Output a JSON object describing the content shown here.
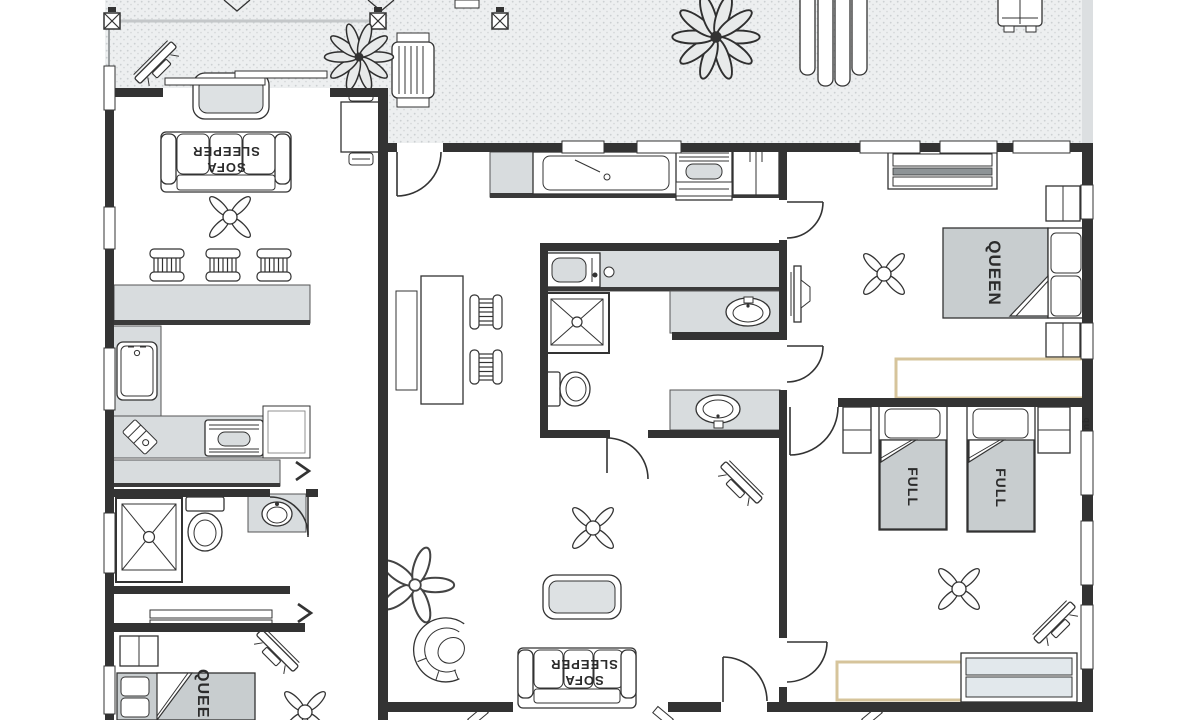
{
  "document": {
    "type": "floor-plan",
    "background": "#ffffff"
  },
  "colors": {
    "wall": "#333333",
    "counter_fill": "#d8dcde",
    "bed_fill": "#c8cdcf",
    "table_fill": "#dde1e3",
    "deck_fill": "#edeff0",
    "deck_dot": "#ccd0d2",
    "closet_border": "#d6c49b",
    "dresser_fill": "#e2e8ec",
    "line": "#333333"
  },
  "labels": {
    "left_unit": {
      "sofa_line1": "SOFA",
      "sofa_line2": "SLEEPER",
      "bed": "QUEEN"
    },
    "main_unit": {
      "living_sofa_line1": "SOFA",
      "living_sofa_line2": "SLEEPER",
      "queen_bed": "QUEEN",
      "full_bed_1": "FULL",
      "full_bed_2": "FULL",
      "wall_note": "qu"
    }
  },
  "fixtures": [
    "deck",
    "railing-post",
    "lounge-chair",
    "plant",
    "sliding-door",
    "window",
    "door-swing",
    "sofa-sleeper",
    "coffee-table",
    "ceiling-fan",
    "bar-stool",
    "kitchen-counter",
    "kitchen-sink",
    "stove",
    "refrigerator",
    "microwave",
    "kitchen-island",
    "shower",
    "toilet",
    "vanity-sink",
    "queen-bed",
    "full-bed",
    "nightstand",
    "dresser",
    "closet",
    "tv",
    "side-table",
    "shelf",
    "armchair"
  ]
}
